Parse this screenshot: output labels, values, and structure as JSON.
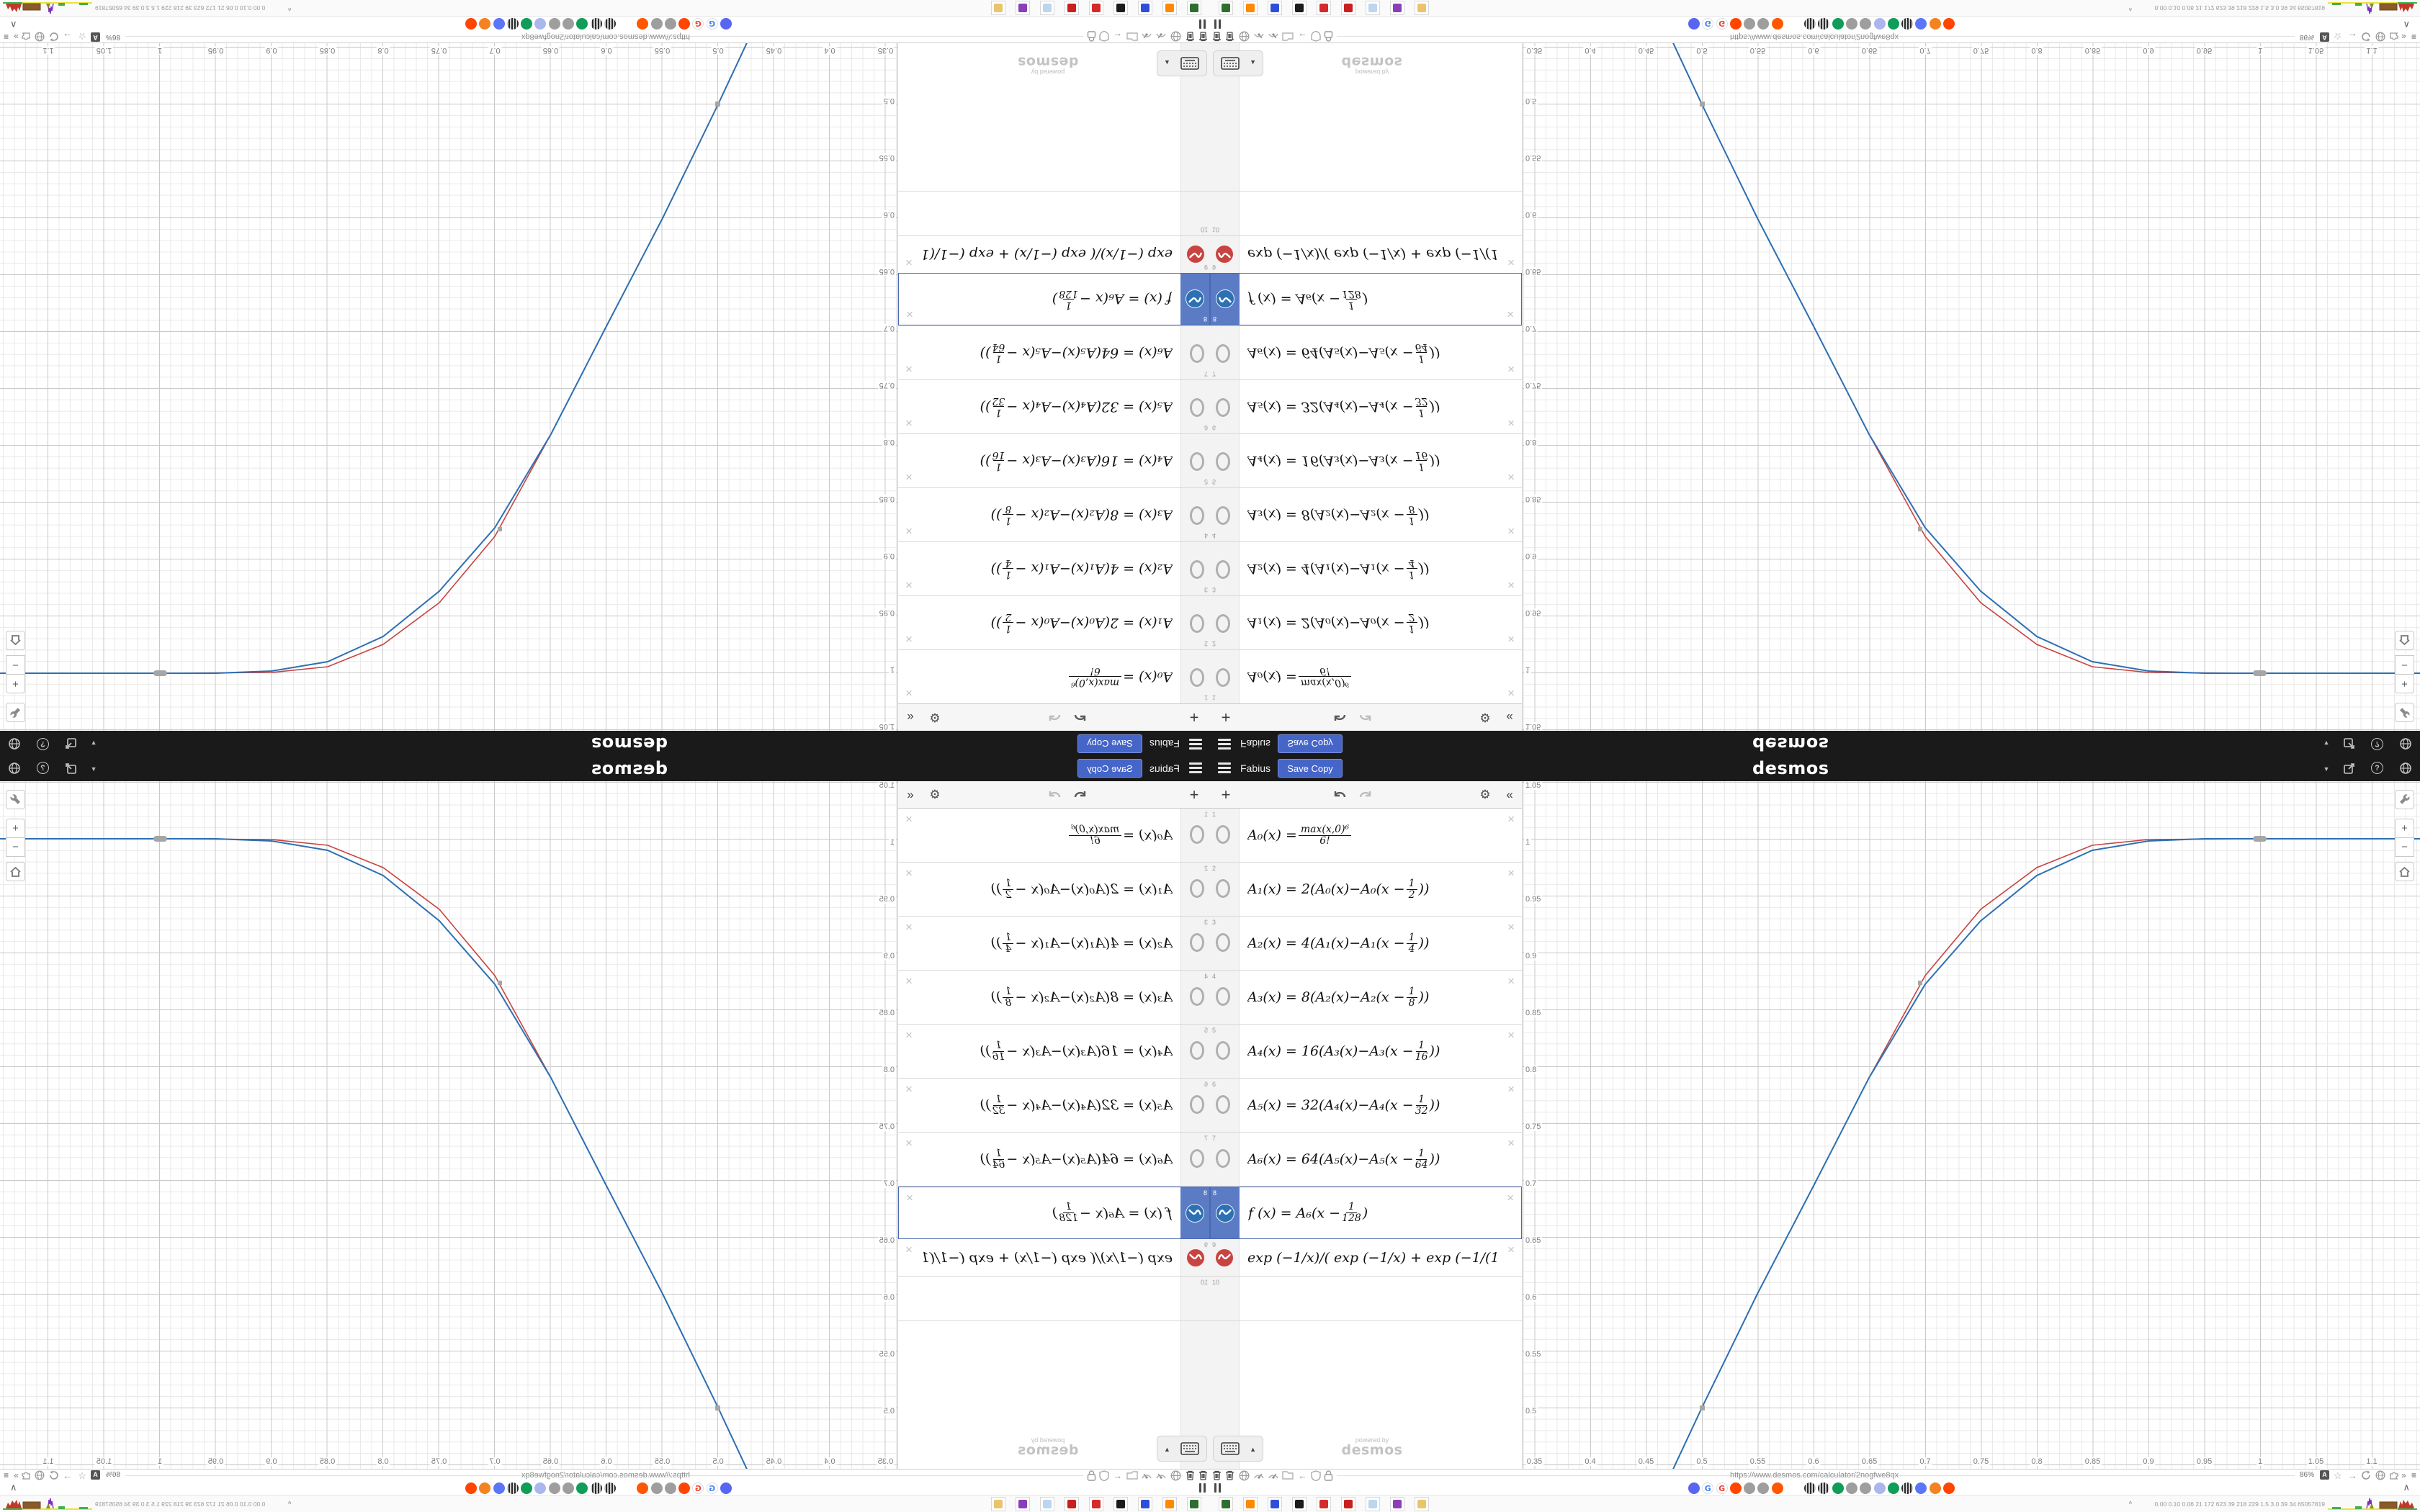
{
  "header": {
    "title": "Fabius",
    "save_copy_label": "Save Copy",
    "logo_text": "desmos",
    "accent_blue": "#4565c8",
    "bar_color": "#1a1a1a",
    "right_icons": [
      "caret-down-icon",
      "share-icon",
      "help-icon",
      "globe-icon"
    ]
  },
  "expressions": {
    "toolbar": {
      "add": "+",
      "undo": "undo-icon",
      "redo": "redo-icon",
      "settings": "gear-icon",
      "collapse": "«"
    },
    "rows": [
      {
        "n": "1",
        "icon": "hidden-circle",
        "f": {
          "pre": "A₀(x) = ",
          "num": "max(x,0)⁶",
          "den": "6!",
          "post": ""
        }
      },
      {
        "n": "2",
        "icon": "hidden-circle",
        "f": {
          "pre": "A₁(x) = 2(A₀(x)−A₀(x − ",
          "num": "1",
          "den": "2",
          "post": "))"
        }
      },
      {
        "n": "3",
        "icon": "hidden-circle",
        "f": {
          "pre": "A₂(x) = 4(A₁(x)−A₁(x − ",
          "num": "1",
          "den": "4",
          "post": "))"
        }
      },
      {
        "n": "4",
        "icon": "hidden-circle",
        "f": {
          "pre": "A₃(x) = 8(A₂(x)−A₂(x − ",
          "num": "1",
          "den": "8",
          "post": "))"
        }
      },
      {
        "n": "5",
        "icon": "hidden-circle",
        "f": {
          "pre": "A₄(x) = 16(A₃(x)−A₃(x − ",
          "num": "1",
          "den": "16",
          "post": "))"
        }
      },
      {
        "n": "6",
        "icon": "hidden-circle",
        "f": {
          "pre": "A₅(x) = 32(A₄(x)−A₄(x − ",
          "num": "1",
          "den": "32",
          "post": "))"
        }
      },
      {
        "n": "7",
        "icon": "hidden-circle",
        "f": {
          "pre": "A₆(x) = 64(A₅(x)−A₅(x − ",
          "num": "1",
          "den": "64",
          "post": "))"
        }
      },
      {
        "n": "8",
        "icon": "wave-blue",
        "selected": true,
        "f": {
          "pre": "f (x) = A₆(x − ",
          "num": "1",
          "den": "128",
          "post": ")"
        }
      },
      {
        "n": "9",
        "icon": "wave-red",
        "f": {
          "text": "exp (−1/x)/( exp (−1/x) + exp (−1/(1 − x)))"
        }
      },
      {
        "n": "10",
        "icon": "none",
        "f": {}
      }
    ],
    "keyboard_button": "keyboard-icon",
    "watermark": {
      "line1": "powered by",
      "line2": "desmos"
    }
  },
  "graph": {
    "y_tick_labels": [
      "1.05",
      "1",
      "0.95",
      "0.9",
      "0.85",
      "0.8",
      "0.75",
      "0.7",
      "0.65",
      "0.6",
      "0.55",
      "0.5"
    ],
    "x_tick_labels": [
      "0.35",
      "0.4",
      "0.45",
      "0.5",
      "0.55",
      "0.6",
      "0.65",
      "0.7",
      "0.75",
      "0.8",
      "0.85",
      "0.9",
      "0.95",
      "1",
      "1.05",
      "1.1"
    ],
    "controls": {
      "wrench": "wrench-icon",
      "zoom_in": "+",
      "zoom_out": "−",
      "home": "home-icon"
    },
    "grid": {
      "minor_step": 0.01,
      "major_step": 0.05,
      "minor_color": "#e9e9e9",
      "major_color": "#c9c9c9"
    }
  },
  "chart_data": {
    "type": "line",
    "title": "Fabius function vs exponential smoothstep",
    "xlabel": "x",
    "ylabel": "y",
    "xlim": [
      0.337,
      1.141
    ],
    "ylim": [
      0.446,
      1.051
    ],
    "x_ticks": [
      0.35,
      0.4,
      0.45,
      0.5,
      0.55,
      0.6,
      0.65,
      0.7,
      0.75,
      0.8,
      0.85,
      0.9,
      0.95,
      1,
      1.05,
      1.1
    ],
    "y_ticks": [
      0.5,
      0.55,
      0.6,
      0.65,
      0.7,
      0.75,
      0.8,
      0.85,
      0.9,
      0.95,
      1,
      1.05
    ],
    "grid": true,
    "legend": "none",
    "series": [
      {
        "name": "f(x) = A₆(x − 1/128)",
        "color": "#2d70b3",
        "points": [
          [
            0.462,
            0.42
          ],
          [
            0.5,
            0.5
          ],
          [
            0.55,
            0.6
          ],
          [
            0.6,
            0.695
          ],
          [
            0.65,
            0.79
          ],
          [
            0.7,
            0.872
          ],
          [
            0.75,
            0.928
          ],
          [
            0.8,
            0.968
          ],
          [
            0.85,
            0.99
          ],
          [
            0.9,
            0.998
          ],
          [
            0.95,
            1.0
          ],
          [
            1.141,
            1.0
          ]
        ]
      },
      {
        "name": "exp(−1/x)/(exp(−1/x)+exp(−1/(1−x)))",
        "color": "#c74440",
        "points": [
          [
            0.462,
            0.42
          ],
          [
            0.5,
            0.5
          ],
          [
            0.55,
            0.603
          ],
          [
            0.6,
            0.7
          ],
          [
            0.65,
            0.795
          ],
          [
            0.7,
            0.88
          ],
          [
            0.75,
            0.938
          ],
          [
            0.8,
            0.975
          ],
          [
            0.85,
            0.994
          ],
          [
            0.9,
            0.9995
          ],
          [
            1.0,
            1.0
          ]
        ]
      }
    ],
    "markers": [
      [
        0.5,
        0.5
      ],
      [
        0.7,
        0.874
      ],
      [
        1.0,
        1.0
      ]
    ]
  },
  "browser_strip": {
    "left_icons": [
      "trash-icon",
      "trash-icon",
      "globe-icon",
      "gauge-icon",
      "gauge-icon",
      "folder-icon",
      "arrow-left-icon",
      "shield-icon",
      "lock-icon"
    ],
    "url": "https://www.desmos.com/calculator/2nogfwe8qx",
    "zoom_badge": "86%",
    "badge_letter": "A",
    "right_icons": [
      "star-icon",
      "arrow-right-icon",
      "reload-icon",
      "globe-icon",
      "puzzle-icon",
      "chevrons-icon",
      "menu-icon"
    ],
    "pause_icon": "pause-icon",
    "tray_chevron": "∧",
    "favicons": [
      {
        "name": "discord",
        "color": "#5865F2"
      },
      {
        "name": "google",
        "color": "#ffffff",
        "glyph": "G",
        "fg": "#4285F4"
      },
      {
        "name": "google",
        "color": "#ffffff",
        "glyph": "G",
        "fg": "#EA4335"
      },
      {
        "name": "reddit",
        "color": "#FF4500"
      },
      {
        "name": "gray-app",
        "color": "#9e9e9e"
      },
      {
        "name": "gray-app",
        "color": "#9e9e9e"
      },
      {
        "name": "reddit",
        "color": "#FF5700"
      },
      {
        "name": "barrel",
        "color": "striped"
      },
      {
        "name": "barrel",
        "color": "striped"
      },
      {
        "name": "desmos-green",
        "color": "#0f9d58"
      },
      {
        "name": "gray-app",
        "color": "#9e9e9e"
      },
      {
        "name": "gray-app",
        "color": "#9e9e9e"
      },
      {
        "name": "user-purple",
        "color": "#aab7ef"
      },
      {
        "name": "desmos-green",
        "color": "#0f9d58"
      },
      {
        "name": "barrel",
        "color": "striped"
      },
      {
        "name": "chat-blue",
        "color": "#5b76f7"
      },
      {
        "name": "gear-orange",
        "color": "#f58220"
      },
      {
        "name": "reddit",
        "color": "#FF4500"
      }
    ]
  },
  "taskbar": {
    "apps": [
      {
        "name": "terminal",
        "color": "#2f6e2f"
      },
      {
        "name": "firefox",
        "color": "#ff8a00"
      },
      {
        "name": "floppy-64",
        "color": "#2f4fd8"
      },
      {
        "name": "bw-app",
        "color": "#1b1b1b"
      },
      {
        "name": "red-gear",
        "color": "#d42a2a"
      },
      {
        "name": "red-flower",
        "color": "#c81f1f"
      },
      {
        "name": "notepad",
        "color": "#bcd6ee"
      },
      {
        "name": "purple-face",
        "color": "#8a3fb8"
      },
      {
        "name": "palette",
        "color": "#e9c46a"
      }
    ],
    "monitor_numbers": "0.00 0.10 0.06 21 172 623 39 218 229 1.5 3.0 39 34 65057819"
  }
}
